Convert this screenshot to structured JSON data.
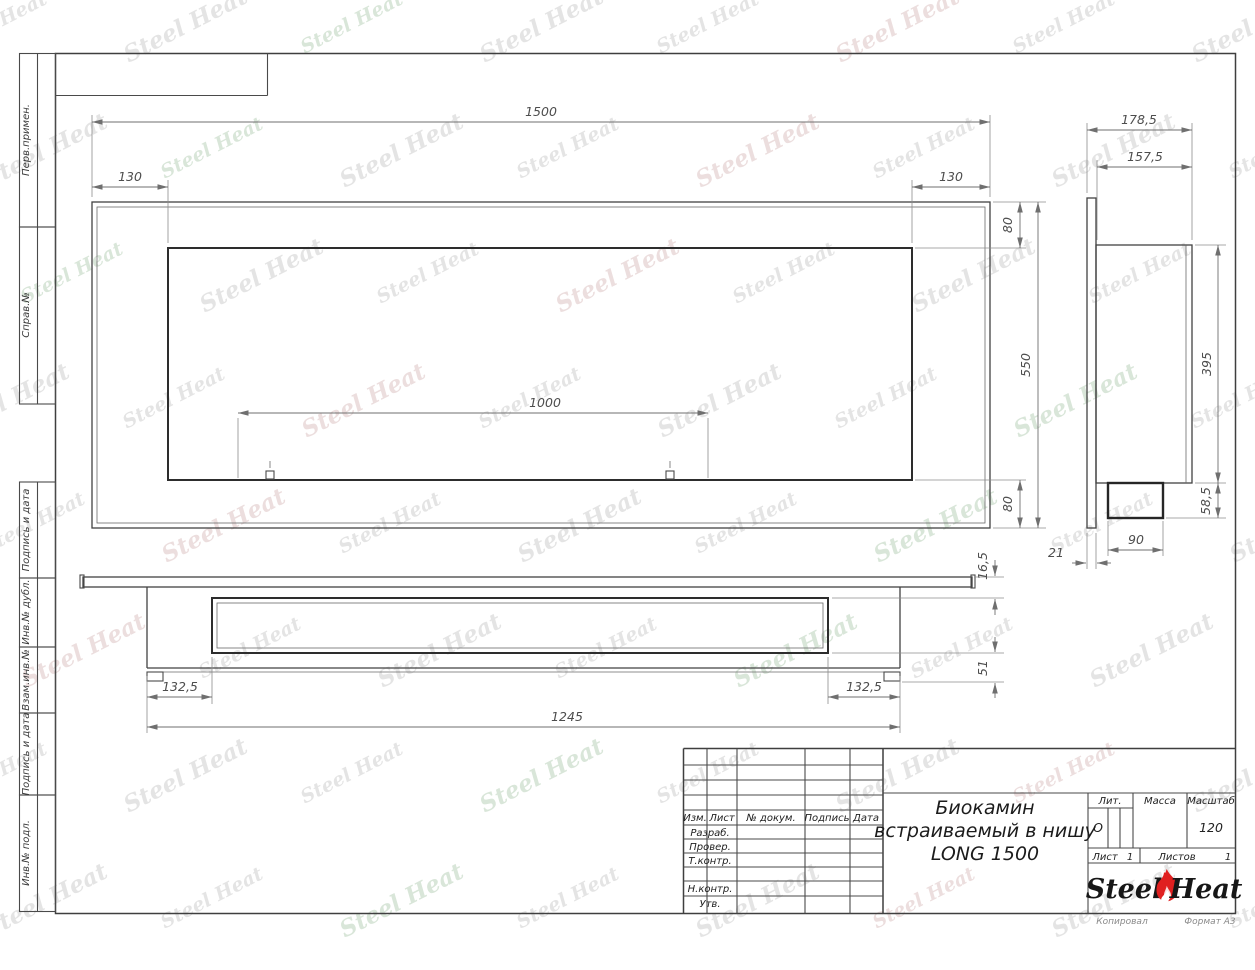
{
  "watermark": {
    "text": "Steel Heat"
  },
  "margin": [
    "Перв.примен.",
    "Справ.№",
    "Подпись и дата",
    "Инв.№ дубл.",
    "Взам.инв.№",
    "Подпись и дата",
    "Инв.№ подл."
  ],
  "dims": {
    "front": {
      "overall": "1500",
      "left": "130",
      "right": "130",
      "top": "80",
      "height": "550",
      "bottom": "80",
      "inner": "1000"
    },
    "side": {
      "overall": "178,5",
      "inner": "157,5",
      "height": "395",
      "lower": "58,5",
      "box": "90",
      "wall": "21"
    },
    "bottom": {
      "lip": "16,5",
      "depth": "51",
      "left": "132,5",
      "right": "132,5",
      "length": "1245"
    }
  },
  "titleblock": {
    "title": [
      "Биокамин",
      "встраиваемый в нишу",
      "LONG 1500"
    ],
    "cols": {
      "izm": "Изм.",
      "list": "Лист",
      "doc": "№ докум.",
      "sign": "Подпись",
      "date": "Дата"
    },
    "rows": [
      "Разраб.",
      "Провер.",
      "Т.контр.",
      "Н.контр.",
      "Утв."
    ],
    "lit": {
      "label": "Лит.",
      "value": "О"
    },
    "mass": {
      "label": "Масса"
    },
    "scale": {
      "label": "Масштаб",
      "value": "120"
    },
    "sheet": {
      "label": "Лист",
      "value": "1"
    },
    "sheets": {
      "label": "Листов",
      "value": "1"
    },
    "logo": {
      "left": "Steel",
      "right": "Heat"
    },
    "footer": {
      "copy": "Копировал",
      "format": "Формат А3"
    }
  }
}
